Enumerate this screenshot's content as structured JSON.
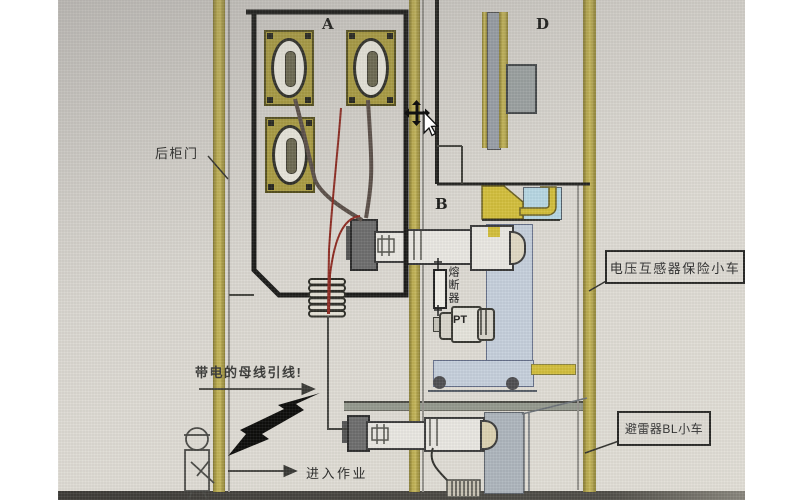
{
  "title": "开关柜内部结构示意图",
  "labels": {
    "rear_door": "后柜门",
    "section_a": "A",
    "section_b": "B",
    "section_d": "D",
    "fuse": "熔断器",
    "pt": "PT",
    "pt_trolley": "电压互感器保险小车",
    "arrester_trolley": "避雷器BL小车",
    "live_busbar_warning": "带电的母线引线!",
    "enter_work": "进入作业"
  },
  "icons": {
    "cursor": "move-cross-pointer",
    "hazard": "lightning-bolt",
    "worker": "stick-figure-person"
  },
  "colors": {
    "photo_background": "#d8d5cf",
    "olive_strip": "#b0a246",
    "bright_yellow": "#d3bf3c",
    "light_blue": "#b7d7e3",
    "steel_blue": "#c6d0dc",
    "panel_gray": "#9aa0a8",
    "outline_black": "#1d1d1b",
    "red_line": "#8e2b22",
    "base_band": "#45433f"
  }
}
